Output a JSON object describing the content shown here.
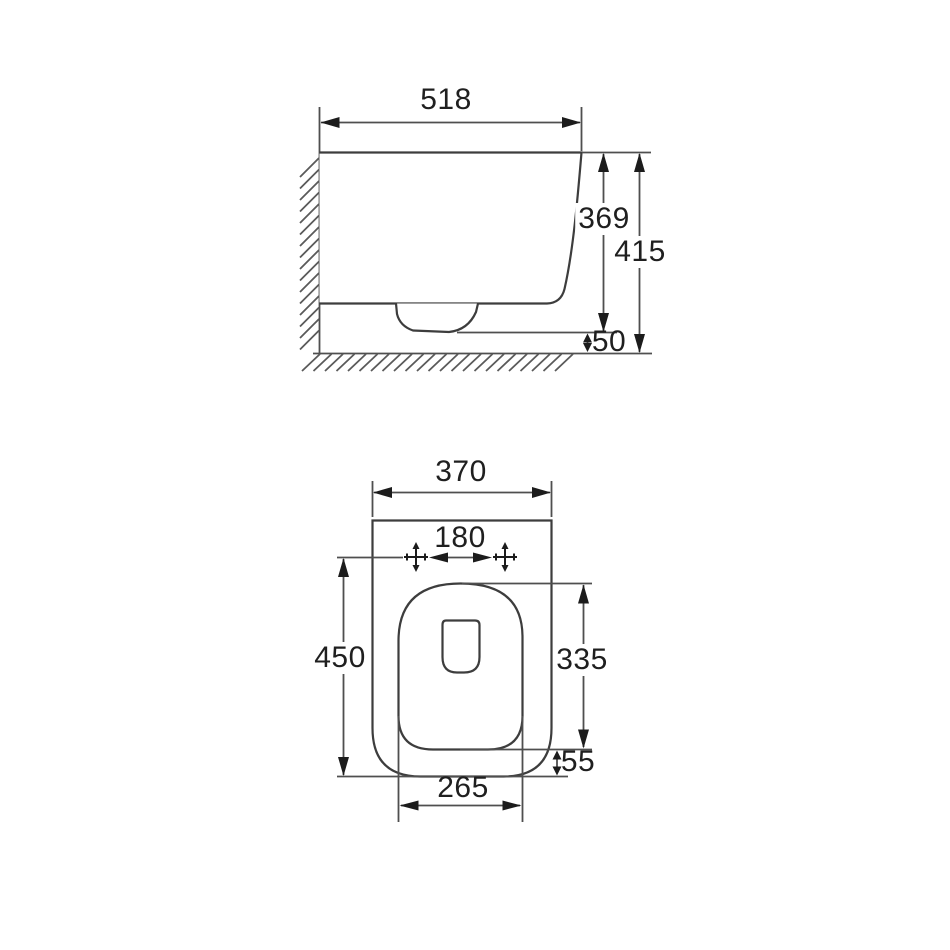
{
  "meta": {
    "type": "technical dimension drawing",
    "subject": "wall-hung toilet, side elevation and plan view",
    "unit": "mm"
  },
  "side_view": {
    "width": "518",
    "height_to_underside": "369",
    "overall_height": "415",
    "floor_clearance": "50"
  },
  "plan_view": {
    "overall_width": "370",
    "fixing_hole_centres": "180",
    "overall_depth": "450",
    "bowl_cutout_depth": "335",
    "front_overhang": "55",
    "bowl_cutout_width": "265"
  },
  "colors": {
    "background": "#ffffff",
    "outline": "#3d3d3d",
    "dimension_lines": "#4f4f4f",
    "text": "#1f1f1f"
  }
}
